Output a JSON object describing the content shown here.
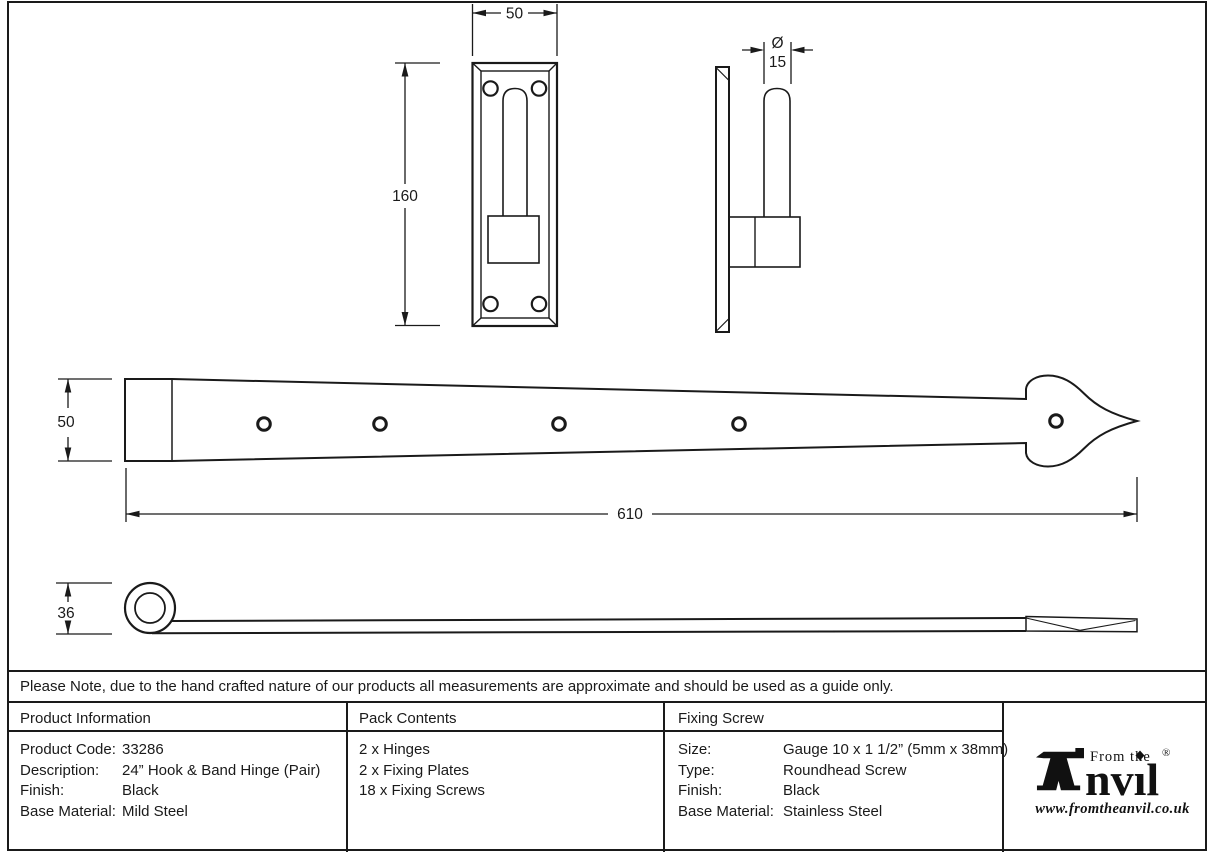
{
  "drawing": {
    "plate_front": {
      "width": "50",
      "height": "160"
    },
    "hook_side": {
      "diameter_symbol": "Ø",
      "diameter": "15"
    },
    "band_top": {
      "height": "50",
      "length": "610"
    },
    "band_side": {
      "height": "36"
    }
  },
  "note": "Please Note, due to the hand crafted nature of our products all measurements are approximate and should be used as a guide only.",
  "table": {
    "product_information": {
      "title": "Product Information",
      "rows": [
        {
          "label": "Product Code:",
          "value": "33286"
        },
        {
          "label": "Description:",
          "value": "24” Hook & Band Hinge (Pair)"
        },
        {
          "label": "Finish:",
          "value": "Black"
        },
        {
          "label": "Base Material:",
          "value": "Mild Steel"
        }
      ]
    },
    "pack_contents": {
      "title": "Pack Contents",
      "items": [
        "2 x Hinges",
        "2 x Fixing Plates",
        "18 x Fixing Screws"
      ]
    },
    "fixing_screw": {
      "title": "Fixing Screw",
      "rows": [
        {
          "label": "Size:",
          "value": "Gauge 10 x 1 1/2” (5mm x 38mm)"
        },
        {
          "label": "Type:",
          "value": "Roundhead Screw"
        },
        {
          "label": "Finish:",
          "value": "Black"
        },
        {
          "label": "Base Material:",
          "value": "Stainless Steel"
        }
      ]
    },
    "logo": {
      "tagline": "From the",
      "brand_suffix": "nvıl",
      "registered": "®",
      "website": "www.fromtheanvil.co.uk"
    }
  },
  "colors": {
    "line": "#1a1a1a",
    "background": "#ffffff"
  }
}
